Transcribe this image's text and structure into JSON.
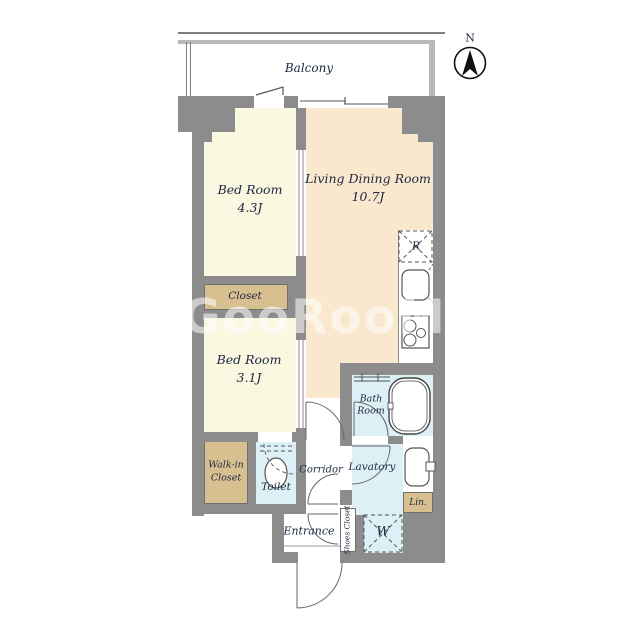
{
  "balcony": {
    "label": "Balcony"
  },
  "compass": {
    "north_label": "N"
  },
  "watermark": {
    "text": "GooRooM"
  },
  "rooms": {
    "bedroom1": {
      "name": "Bed Room",
      "size": "4.3J"
    },
    "bedroom2": {
      "name": "Bed Room",
      "size": "3.1J"
    },
    "living": {
      "name": "Living Dining Room",
      "size": "10.7J"
    },
    "closet": {
      "label": "Closet"
    },
    "walkin_closet": {
      "line1": "Walk-in",
      "line2": "Closet"
    },
    "toilet": {
      "label": "Toilet"
    },
    "corridor": {
      "label": "Corridor"
    },
    "bathroom": {
      "line1": "Bath",
      "line2": "Room"
    },
    "lavatory": {
      "label": "Lavatory"
    },
    "linen": {
      "label": "Lin."
    },
    "entrance": {
      "label": "Entrance"
    },
    "shoes_closet": {
      "label": "Shoes Closet"
    }
  },
  "appliances": {
    "refrigerator": "R",
    "washer": "W"
  },
  "colors": {
    "wall": "#8c8c8c",
    "cream": "#faf8e1",
    "peach": "#fae8ce",
    "tan": "#d8bf90",
    "blue": "#dcf0f6",
    "line": "#4a4a4a",
    "label": "#1d2742"
  }
}
